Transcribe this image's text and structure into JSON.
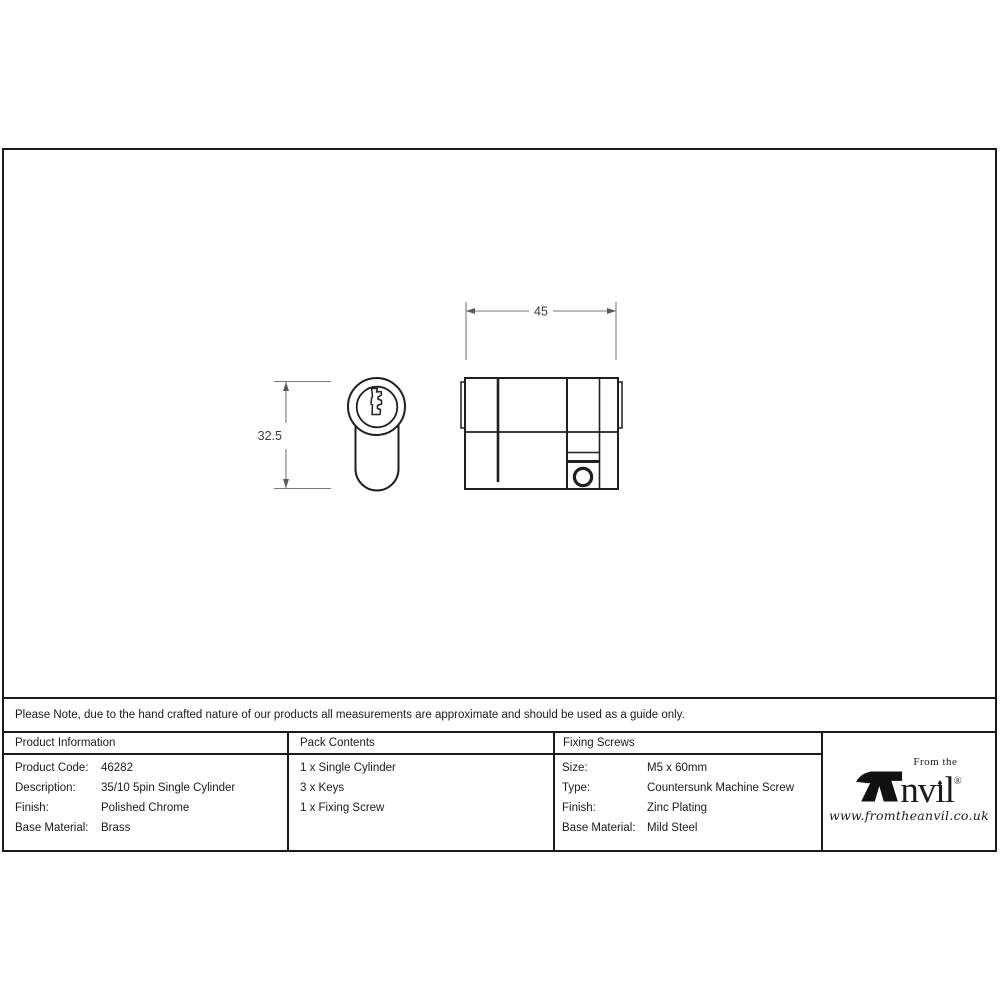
{
  "note": {
    "text": "Please Note, due to the hand crafted nature of our products all measurements are approximate and should be used as a guide only."
  },
  "drawing": {
    "width_dim": "45",
    "height_dim": "32.5"
  },
  "table": {
    "product_information": {
      "header": "Product Information",
      "rows": [
        {
          "label": "Product Code:",
          "value": "46282"
        },
        {
          "label": "Description:",
          "value": "35/10 5pin Single Cylinder"
        },
        {
          "label": "Finish:",
          "value": "Polished Chrome"
        },
        {
          "label": "Base Material:",
          "value": "Brass"
        }
      ]
    },
    "pack_contents": {
      "header": "Pack Contents",
      "items": [
        "1 x Single Cylinder",
        "3 x Keys",
        "1 x Fixing Screw"
      ]
    },
    "fixing_screws": {
      "header": "Fixing Screws",
      "rows": [
        {
          "label": "Size:",
          "value": "M5 x 60mm"
        },
        {
          "label": "Type:",
          "value": "Countersunk Machine Screw"
        },
        {
          "label": "Finish:",
          "value": "Zinc Plating"
        },
        {
          "label": "Base Material:",
          "value": "Mild Steel"
        }
      ]
    }
  },
  "logo": {
    "tagline": "From the",
    "brand_nv": "nv",
    "brand_i_dot": "♦",
    "brand_i_stem": "ı",
    "brand_l": "l",
    "registered": "®",
    "website": "www.fromtheanvil.co.uk"
  },
  "colors": {
    "line": "#1a1a1a",
    "dim_line": "#7a7a7a",
    "text": "#1a1a1a"
  }
}
